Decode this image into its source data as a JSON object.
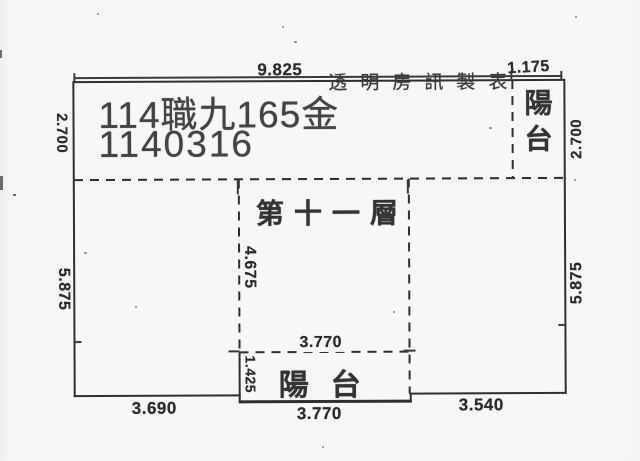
{
  "document": {
    "case_label": "114職九165金",
    "date_code": "1140316",
    "watermark": "透明房訊製表"
  },
  "plan": {
    "floor_label": "第十一層",
    "balcony_top_right": "陽台",
    "balcony_bottom": "陽台"
  },
  "dimensions": {
    "top_main": "9.825",
    "top_balcony": "1.175",
    "left_upper": "2.700",
    "left_lower": "5.875",
    "right_upper": "2.700",
    "right_lower": "5.875",
    "inner_height": "4.675",
    "inner_width": "3.770",
    "balcony_height": "1.425",
    "bottom_left": "3.690",
    "bottom_middle": "3.770",
    "bottom_right": "3.540"
  },
  "colors": {
    "ink": "#2f2f2f",
    "paper": "#f7f7f4"
  }
}
